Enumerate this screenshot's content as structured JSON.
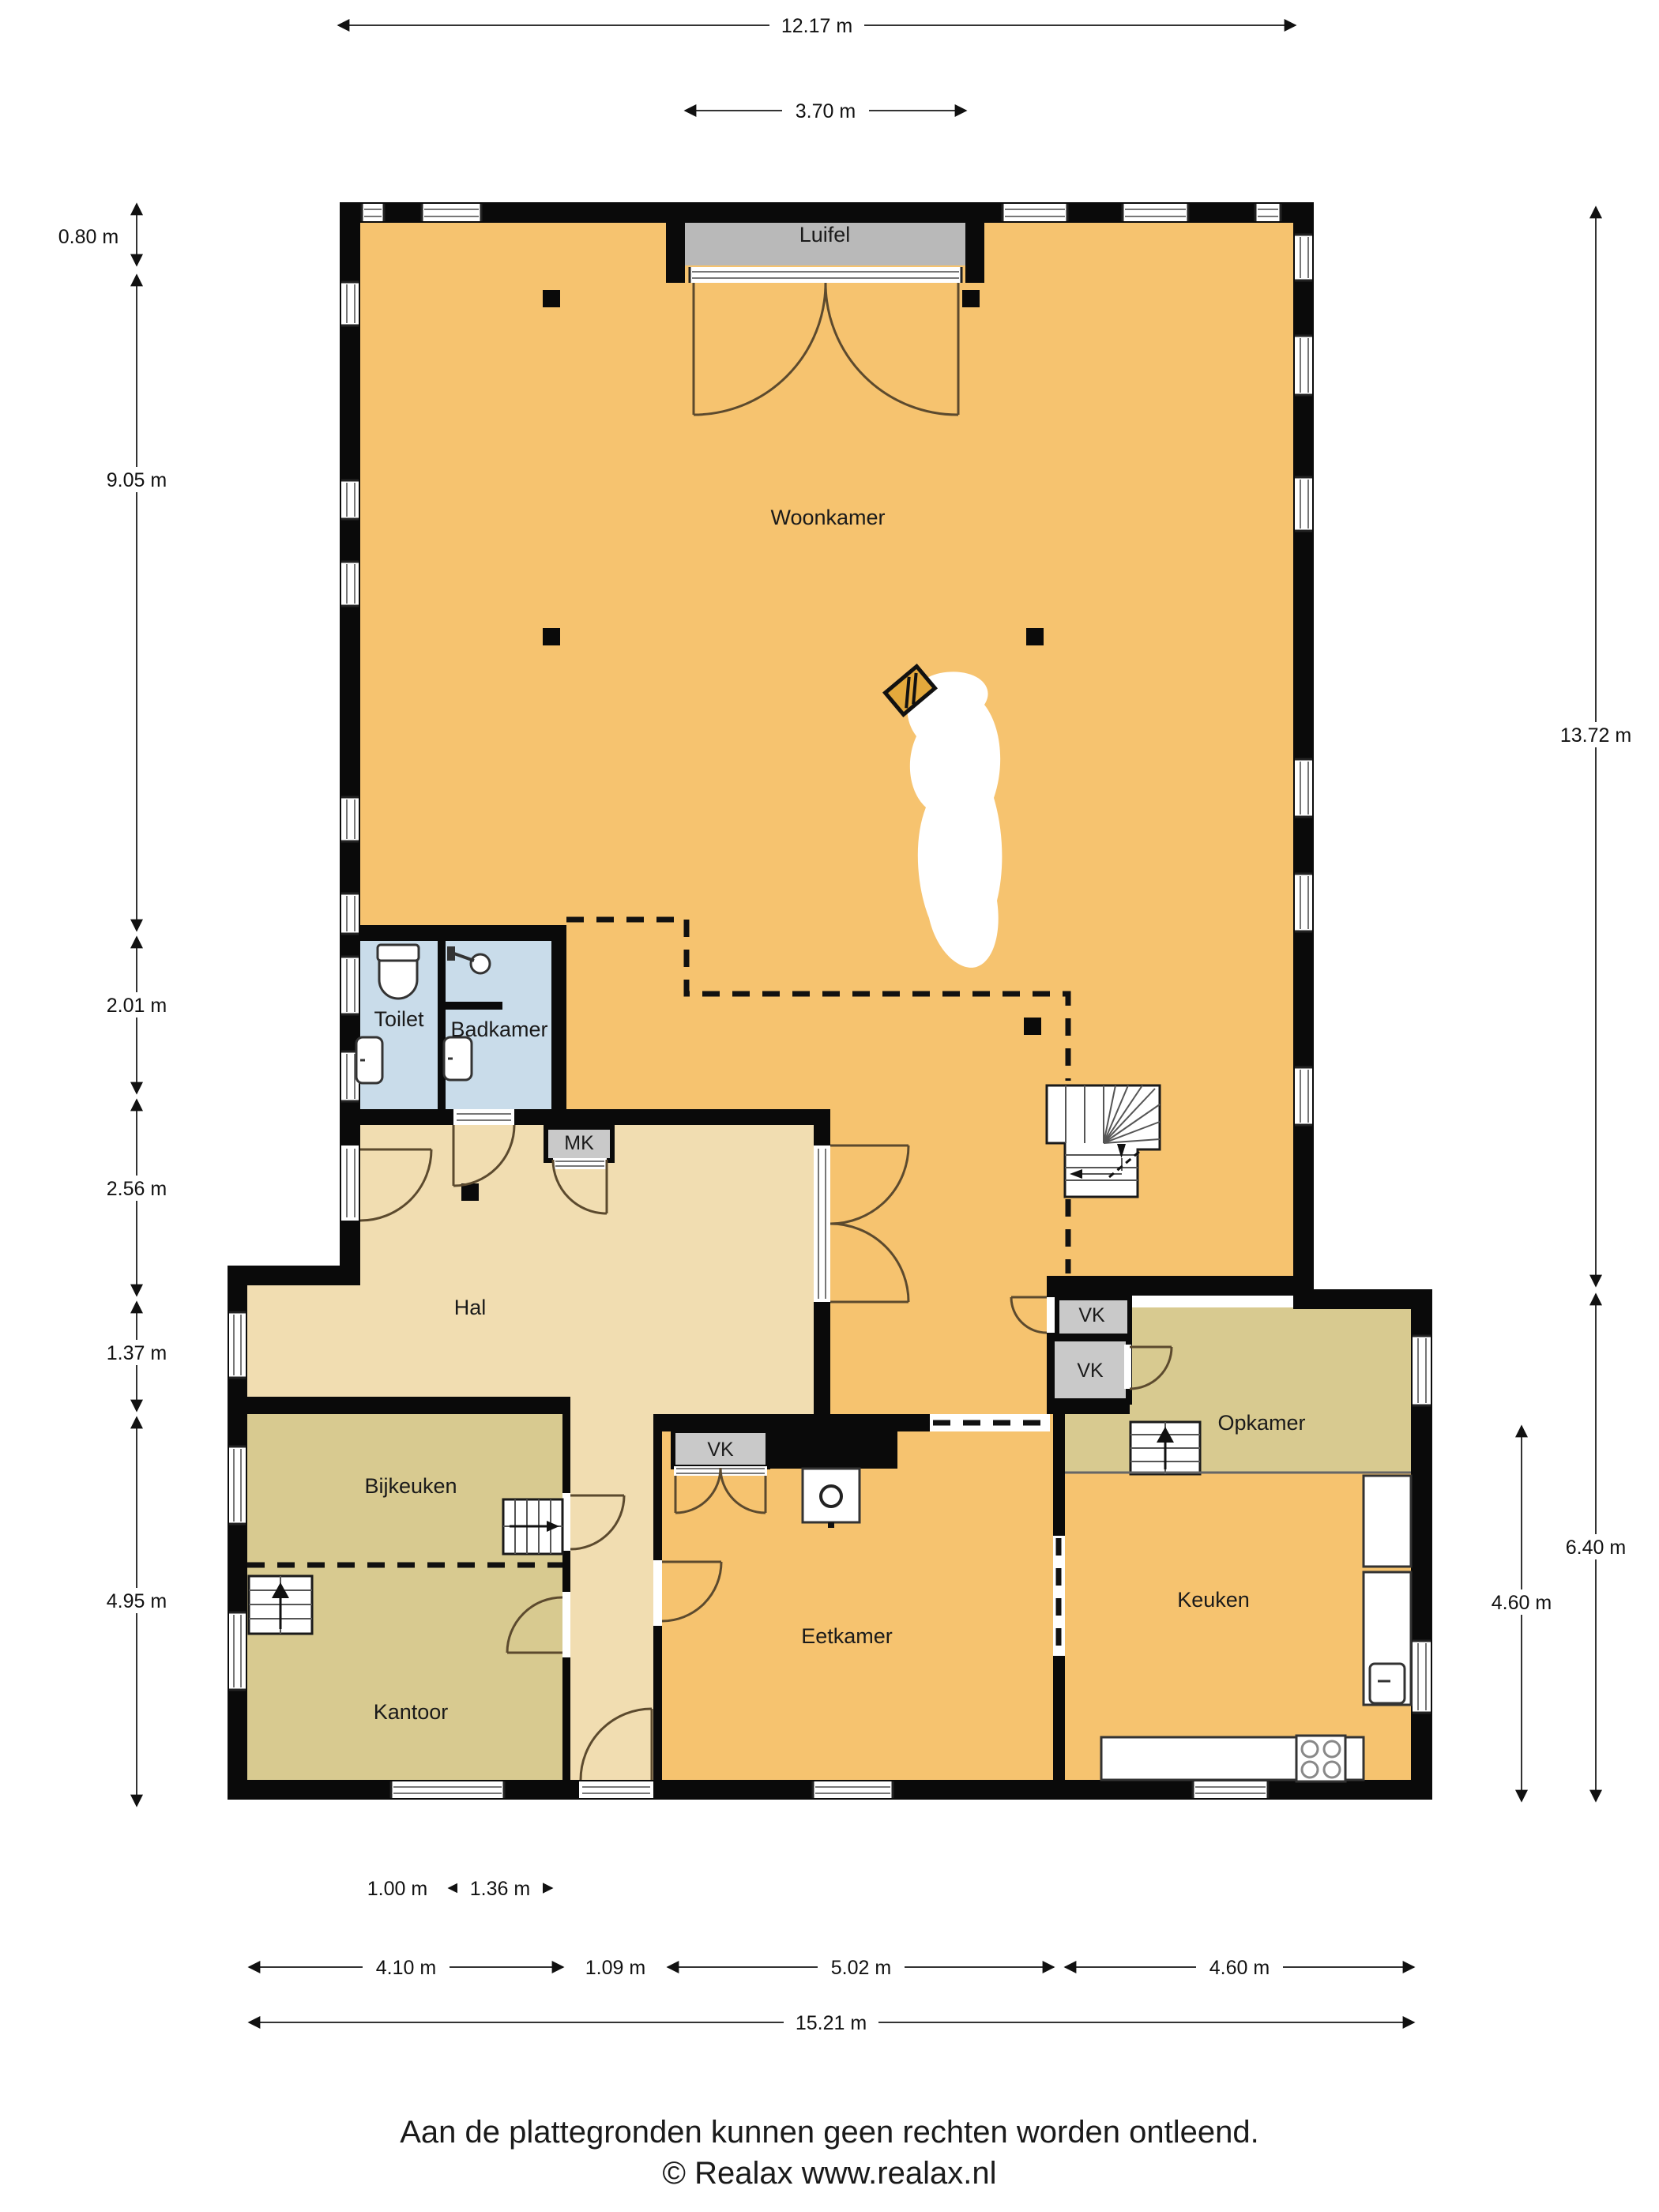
{
  "rooms": {
    "woonkamer": "Woonkamer",
    "luifel": "Luifel",
    "toilet": "Toilet",
    "badkamer": "Badkamer",
    "mk": "MK",
    "hal": "Hal",
    "bijkeuken": "Bijkeuken",
    "kantoor": "Kantoor",
    "eetkamer": "Eetkamer",
    "opkamer": "Opkamer",
    "keuken": "Keuken",
    "vk_woonkamer": "VK",
    "vk_opkamer": "VK",
    "vk_eetkamer": "VK"
  },
  "dimensions": {
    "top": [
      "12.17 m",
      "3.70 m"
    ],
    "left": [
      "0.80 m",
      "9.05 m",
      "2.01 m",
      "2.56 m",
      "1.37 m",
      "4.95 m"
    ],
    "right": [
      "13.72 m",
      "6.40 m",
      "4.60 m"
    ],
    "bottom_inner": [
      "1.00 m",
      "1.36 m"
    ],
    "bottom_mid": [
      "4.10 m",
      "1.09 m",
      "5.02 m",
      "4.60 m"
    ],
    "bottom_total": "15.21 m"
  },
  "footer": {
    "disclaimer": "Aan de plattegronden kunnen geen rechten worden ontleend.",
    "copyright": "© Realax www.realax.nl"
  },
  "colors": {
    "orange": "#F6C36F",
    "tan": "#F1DDB1",
    "khaki": "#D8CA90",
    "blue": "#C9DCEA",
    "luifel_gray": "#B9B9B9",
    "closet_gray": "#C9C9C9",
    "wall": "#0a0a0a"
  }
}
